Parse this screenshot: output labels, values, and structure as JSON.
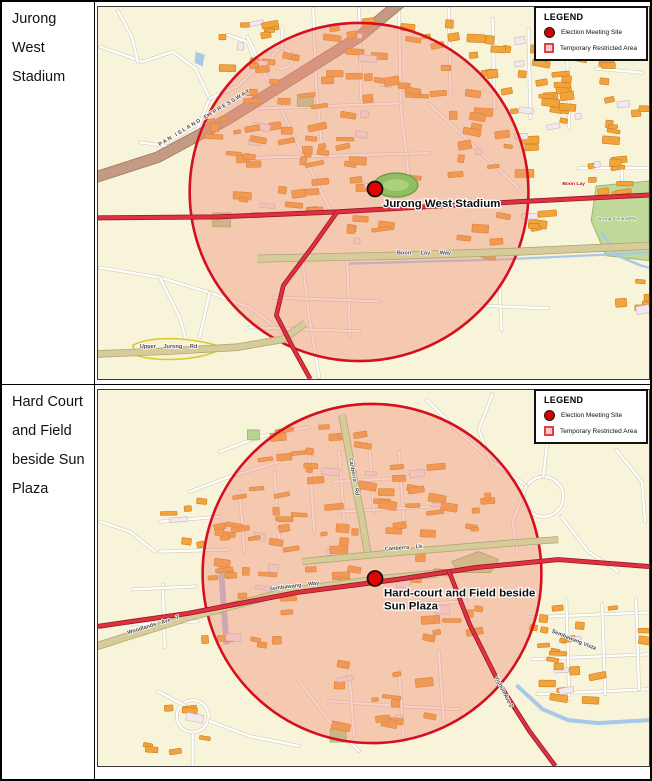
{
  "rows": [
    {
      "label": "Jurong West Stadium"
    },
    {
      "label": "Hard Court and Field beside Sun Plaza"
    }
  ],
  "legend": {
    "title": "LEGEND",
    "meeting_site": "Election Meeting Site",
    "restricted_area": "Temporary Restricted Area"
  },
  "colors": {
    "restricted_area_border": "#d40f20",
    "restricted_area_fill": "rgba(240,140,120,0.42)",
    "site_marker": "#e60000",
    "legend_dot": "#d60000",
    "legend_square_fill": "#f8cdd2",
    "legend_square_border": "#e04048"
  },
  "maps": [
    {
      "site_lines": [
        "Jurong West Stadium"
      ],
      "labels": {
        "expressway": "PAN ISLAND EXPRESSWAY",
        "boon_lay_way": "Boon Lay Way",
        "upper_jurong_rd": "Upper Jurong Rd",
        "jurong_central_pk": "Jurong Central Pk",
        "boon_lay_station": "Boon Lay"
      }
    },
    {
      "site_lines": [
        "Hard-court and Field beside",
        "Sun Plaza"
      ],
      "labels": {
        "sembawang_way": "Sembawang Way",
        "woodlands_ave": "Woodlands Ave 7",
        "canberra_rd": "Canberra Rd",
        "canberra_lk": "Canberra Lk",
        "sembawang_vista": "Sembawang Vista",
        "yishun_ave": "Yishun Ave 2"
      }
    }
  ]
}
